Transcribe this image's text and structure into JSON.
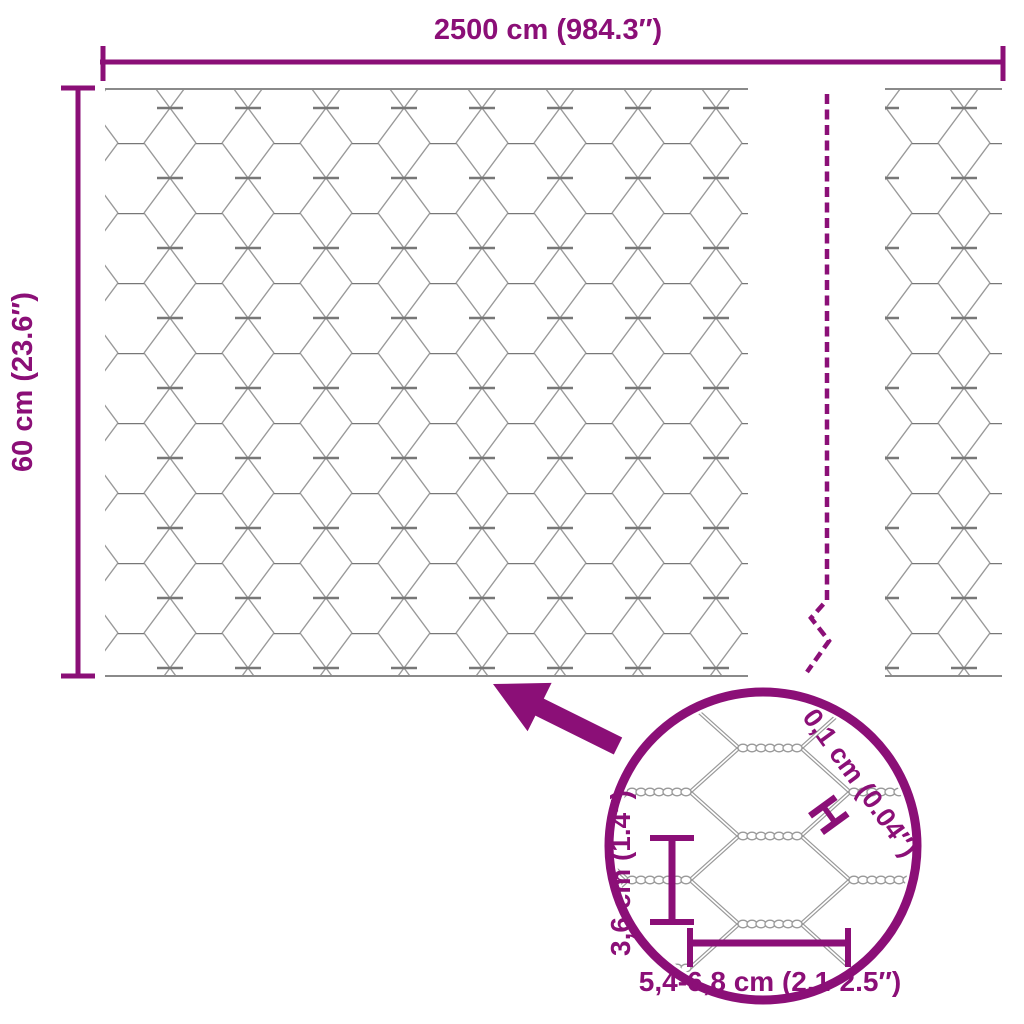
{
  "title": "Hexagonal wire mesh dimensions diagram",
  "colors": {
    "accent": "#8B0F77",
    "mesh": "#999999",
    "mesh_dark": "#777777",
    "background": "#ffffff"
  },
  "dimensions": {
    "width_label": "2500 cm (984.3″)",
    "height_label": "60 cm (23.6″)"
  },
  "detail": {
    "wire_thickness_label": "0,1 cm (0.04″)",
    "wire_thickness_marker": "H",
    "mesh_height_label": "3,6 cm (1.4″)",
    "mesh_width_label": "5,4-6,8 cm (2.1-2.5″)"
  },
  "icons": {
    "zoom_arrow": "thick-arrow-up-left",
    "break_line": "dashed-break-line",
    "magnifier": "detail-circle"
  }
}
